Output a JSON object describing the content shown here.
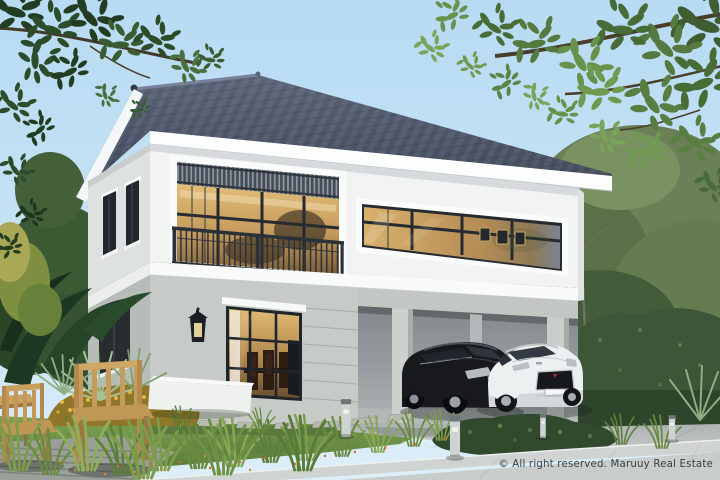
{
  "watermark": {
    "text": "© All right reserved. Maruuy Real Estate",
    "color": "#3a3f45"
  },
  "scene": {
    "floors": 2,
    "cars": 2
  },
  "palette": {
    "sky": "#c3e0f5",
    "roof": "#4e5569",
    "fascia": "#fcfdfd",
    "upper_wall": "#f2f4f4",
    "upper_side_wall": "#dde1df",
    "lower_wall": "#c6cbc7",
    "lower_side_wall": "#b7bcb8",
    "window_frame": "#262b31",
    "interior_glow": "#d6a960",
    "lawn": "#6f9049",
    "driveway": "#b5babb",
    "sidewalk": "#cfd3d1",
    "hedge": "#3d5637",
    "canopy": "#5d8547",
    "car_black": "#17191d",
    "car_white": "#edf0f1",
    "wood": "#c79e5d",
    "flower_shrub": "#d1a52f",
    "bollard": "#c9cecf"
  }
}
